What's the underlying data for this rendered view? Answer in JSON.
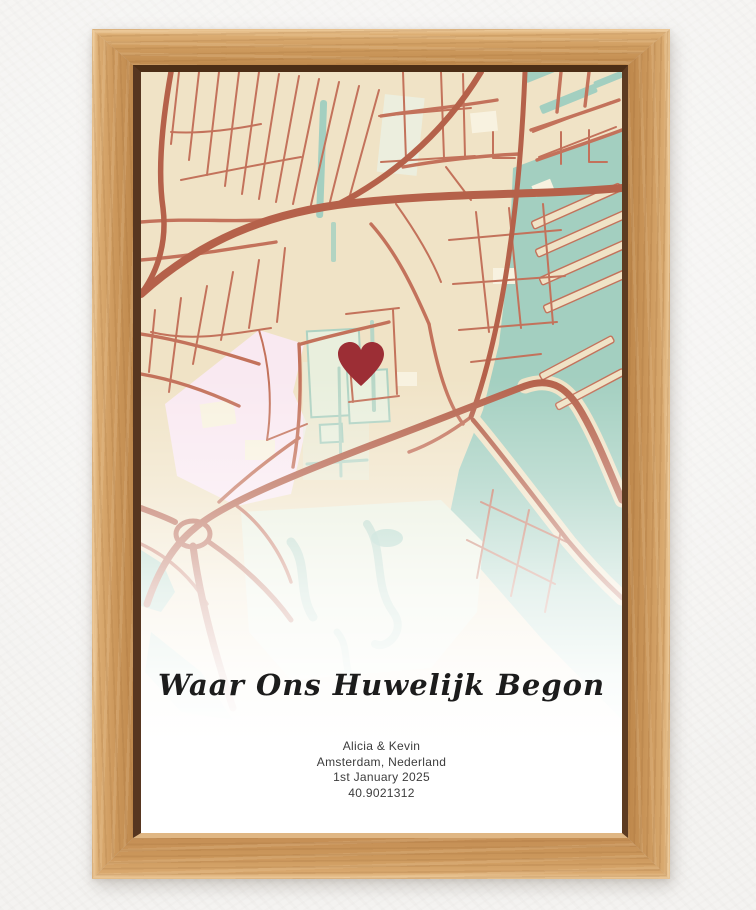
{
  "poster": {
    "title": "Waar Ons Huwelijk Begon",
    "names": "Alicia & Kevin",
    "location": "Amsterdam, Nederland",
    "date": "1st January 2025",
    "coordinates": "40.9021312"
  },
  "map": {
    "marker_icon": "heart-icon",
    "colors": {
      "land": "#f0e3c6",
      "road": "#c3725b",
      "road_major": "#b5614a",
      "water": "#a3cfc0",
      "park": "#e9efdd",
      "pond": "#b7d6c6",
      "district": "#f9e9f1",
      "building": "#f8f2e0",
      "marker": "#9c2e35"
    }
  },
  "frame": {
    "material_color": "#cf9a5e",
    "wall_color": "#f4f3f1"
  }
}
